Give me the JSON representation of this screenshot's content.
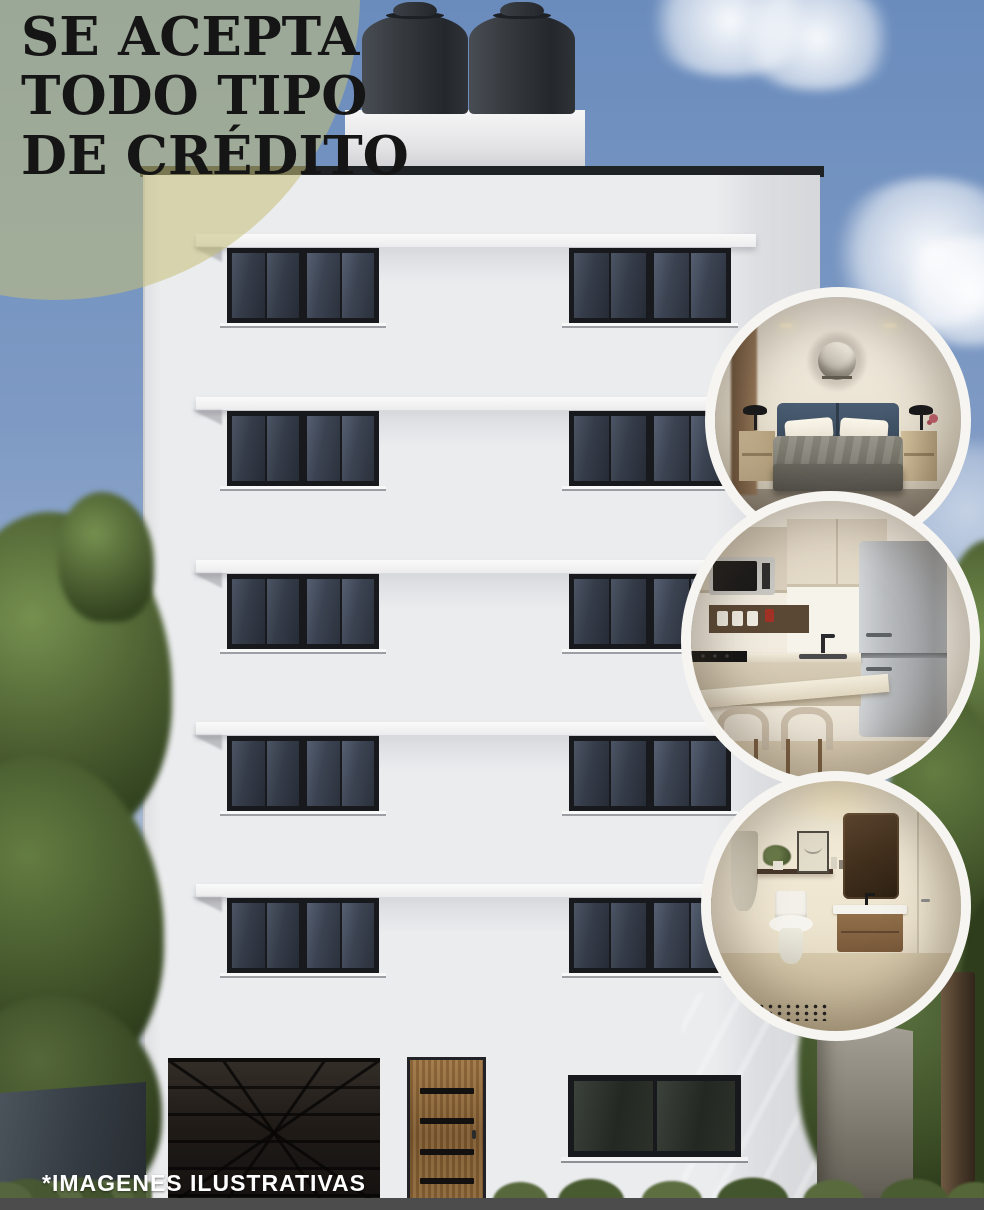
{
  "poster": {
    "kind": "real-estate-flyer",
    "width": 984,
    "height": 1210
  },
  "header": {
    "lines": [
      "SE ACEPTA",
      "TODO TIPO",
      "DE CRÉDITO"
    ]
  },
  "footer": {
    "note": "*IMAGENES ILUSTRATIVAS"
  },
  "insets": [
    {
      "name": "bedroom-photo"
    },
    {
      "name": "kitchen-photo"
    },
    {
      "name": "bathroom-photo"
    }
  ],
  "colors": {
    "overlay-circle": "rgba(196,191,121,0.55)",
    "heading-text": "#151515",
    "footer-text": "#ffffff",
    "footer-bar": "#4c4c4c",
    "circle-ring": "#f6f5f1",
    "sky-top": "#6a8cbd",
    "facade": "#ebecee",
    "window-frame": "#17191c",
    "window-glass": "#262c36",
    "water-tank": "#35393e",
    "tree-green": "#4f6233"
  }
}
